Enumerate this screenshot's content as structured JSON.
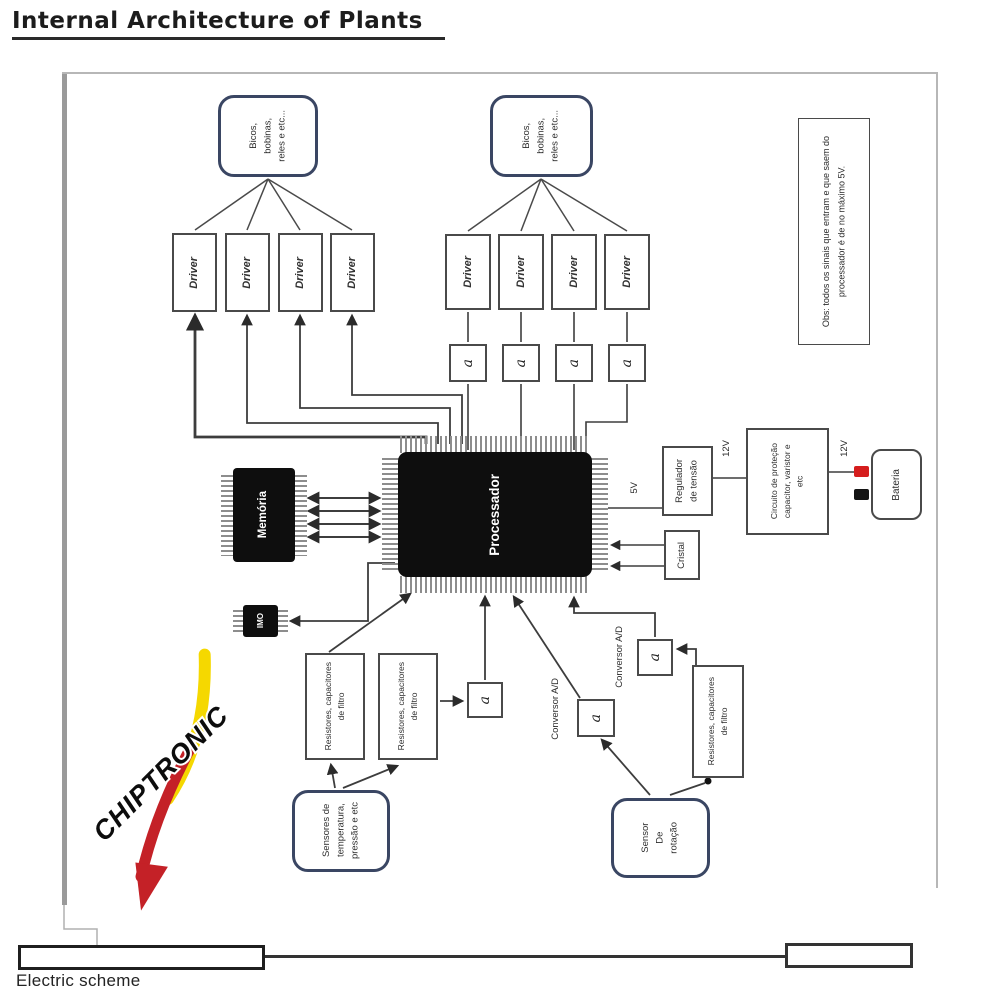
{
  "title": "Internal Architecture of Plants",
  "footer": {
    "label": "Electric scheme"
  },
  "diagram": {
    "actuators": {
      "lines": [
        "Bicos,",
        "bobinas,",
        "reles e etc..."
      ]
    },
    "driver": "Driver",
    "ci": "a",
    "processor": "Processador",
    "memory": "Memória",
    "imo": "IMO",
    "note": {
      "lines": [
        "Obs: todos os sinais que entram e que saem do",
        "processador é de no máximo 5V."
      ]
    },
    "voltage_5v": "5V",
    "voltage_12v": "12V",
    "regulator": {
      "lines": [
        "Regulador",
        "de tensão"
      ]
    },
    "protection": {
      "lines": [
        "Circuito de proteção",
        "capacitor, varistor e",
        "etc"
      ]
    },
    "battery": "Bateria",
    "crystal": "Cristal",
    "filter": {
      "lines": [
        "Resistores, capacitores",
        "de filtro"
      ]
    },
    "temperature_sensors": {
      "lines": [
        "Sensores de",
        "temperatura,",
        "pressão e etc"
      ]
    },
    "adc": "Conversor A/D",
    "rotation_sensor": {
      "lines": [
        "Sensor",
        "De",
        "rotação"
      ]
    },
    "logo": "CHIPTRONIC",
    "colors": {
      "accent_border": "#3a4663",
      "logo_red": "#c42127",
      "logo_yellow": "#f5d800",
      "battery_positive": "#d51d1d",
      "battery_negative": "#141414"
    }
  }
}
